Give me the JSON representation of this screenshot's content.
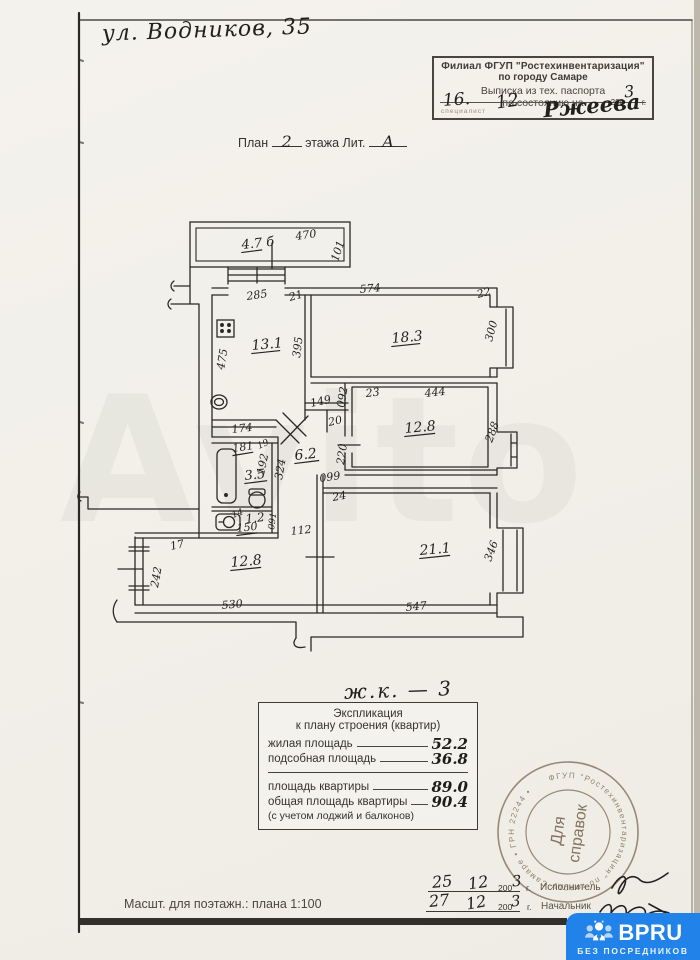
{
  "address": "ул. Водников, 35",
  "stamp_box": {
    "line1": "Филиал ФГУП  \"Ростехинвентаризация\"",
    "line2": "по городу Самаре",
    "line3": "Выписка из тех. паспорта",
    "line4": "по состоянию на",
    "day": "16.",
    "month": "12",
    "year_printed": "200",
    "year_hand": "3",
    "year_unit": "г.",
    "clerk": "специалист",
    "signature": "Ржеева"
  },
  "plan_title": {
    "prefix": "План",
    "floor": "2",
    "middle": "этажа Лит.",
    "letter": "А"
  },
  "apartment_mark": "ж.к. — 3",
  "explication": {
    "title1": "Экспликация",
    "title2": "к плану строения (квартир)",
    "rows": [
      {
        "label": "жилая площадь",
        "value": "52.2"
      },
      {
        "label": "подсобная площадь",
        "value": "36.8"
      },
      {
        "label": "площадь квартиры",
        "value": "89.0"
      },
      {
        "label": "общая площадь квартиры",
        "value": "90.4"
      }
    ],
    "note": "(с учетом лоджий и балконов)"
  },
  "round_stamp": {
    "line1": "Для",
    "line2": "справок",
    "ring_text": "ФГУП \"Ростехинвентаризация\"  по городу Самаре  •  ГРН 22244  •"
  },
  "signoff": [
    {
      "day": "25",
      "month": "12",
      "year_printed": "200",
      "year_hand": "3",
      "year_unit": "г.",
      "role": "Исполнитель"
    },
    {
      "day": "27",
      "month": "12",
      "year_printed": "200",
      "year_hand": "3",
      "year_unit": "г.",
      "role": "Начальник"
    }
  ],
  "scale_note": "Масшт. для поэтажн.: плана 1:100",
  "watermark": {
    "ghost_text": "Avito",
    "badge_title": "BPRU",
    "badge_subtitle": "БЕЗ ПОСРЕДНИКОВ",
    "badge_color": "#2183e9",
    "badge_icon": "people-lock-icon"
  },
  "plan": {
    "labels": [
      {
        "t": "470",
        "x": 296,
        "y": 240,
        "r": -8
      },
      {
        "t": "101",
        "x": 338,
        "y": 262,
        "r": -72
      },
      {
        "t": "4.7 б",
        "x": 242,
        "y": 249,
        "r": -6,
        "fs": 13,
        "u": 20,
        "room": 1
      },
      {
        "t": "285",
        "x": 247,
        "y": 300,
        "r": -8
      },
      {
        "t": "21",
        "x": 290,
        "y": 301,
        "r": -15
      },
      {
        "t": "574",
        "x": 360,
        "y": 293,
        "r": -5
      },
      {
        "t": "22",
        "x": 478,
        "y": 298,
        "r": -15
      },
      {
        "t": "475",
        "x": 224,
        "y": 370,
        "r": -80
      },
      {
        "t": "395",
        "x": 300,
        "y": 358,
        "r": -83
      },
      {
        "t": "13.1",
        "x": 252,
        "y": 350,
        "r": -5,
        "fs": 14,
        "u": 28,
        "room": 1
      },
      {
        "t": "18.3",
        "x": 392,
        "y": 343,
        "r": -5,
        "fs": 14,
        "u": 28,
        "room": 1
      },
      {
        "t": "300",
        "x": 492,
        "y": 342,
        "r": -75
      },
      {
        "t": "23",
        "x": 366,
        "y": 397,
        "r": -6
      },
      {
        "t": "444",
        "x": 425,
        "y": 397,
        "r": -6
      },
      {
        "t": "12.8",
        "x": 405,
        "y": 433,
        "r": -5,
        "fs": 14,
        "u": 30,
        "room": 1
      },
      {
        "t": "288",
        "x": 492,
        "y": 443,
        "r": -70
      },
      {
        "t": "149",
        "x": 311,
        "y": 407,
        "r": -12
      },
      {
        "t": "092",
        "x": 344,
        "y": 408,
        "r": -80
      },
      {
        "t": "20",
        "x": 329,
        "y": 426,
        "r": -12
      },
      {
        "t": "220",
        "x": 344,
        "y": 465,
        "r": -82
      },
      {
        "t": "6.2",
        "x": 295,
        "y": 460,
        "r": -6,
        "fs": 14,
        "u": 24,
        "room": 1
      },
      {
        "t": "174",
        "x": 232,
        "y": 433,
        "r": -6
      },
      {
        "t": "181",
        "x": 233,
        "y": 452,
        "r": -8,
        "u": 20
      },
      {
        "t": "19",
        "x": 259,
        "y": 449,
        "r": -25,
        "fs": 9
      },
      {
        "t": "192",
        "x": 264,
        "y": 475,
        "r": -78
      },
      {
        "t": "324",
        "x": 282,
        "y": 480,
        "r": -80
      },
      {
        "t": "3.5",
        "x": 245,
        "y": 480,
        "r": -6,
        "fs": 13,
        "u": 22,
        "room": 1
      },
      {
        "t": "099",
        "x": 320,
        "y": 482,
        "r": -8
      },
      {
        "t": "24",
        "x": 333,
        "y": 501,
        "r": -10
      },
      {
        "t": "14",
        "x": 233,
        "y": 518,
        "r": -20,
        "fs": 9
      },
      {
        "t": "1.2",
        "x": 246,
        "y": 523,
        "r": -6,
        "fs": 12,
        "room": 1
      },
      {
        "t": "150",
        "x": 237,
        "y": 532,
        "r": -6,
        "u": 20
      },
      {
        "t": "091",
        "x": 274,
        "y": 530,
        "r": -82,
        "fs": 9
      },
      {
        "t": "112",
        "x": 291,
        "y": 535,
        "r": -6
      },
      {
        "t": "17",
        "x": 171,
        "y": 550,
        "r": -12
      },
      {
        "t": "12.8",
        "x": 231,
        "y": 567,
        "r": -5,
        "fs": 14,
        "u": 30,
        "room": 1
      },
      {
        "t": "242",
        "x": 158,
        "y": 588,
        "r": -80
      },
      {
        "t": "530",
        "x": 222,
        "y": 609,
        "r": -5
      },
      {
        "t": "21.1",
        "x": 420,
        "y": 555,
        "r": -5,
        "fs": 14,
        "u": 30,
        "room": 1
      },
      {
        "t": "346",
        "x": 491,
        "y": 562,
        "r": -70
      },
      {
        "t": "547",
        "x": 406,
        "y": 611,
        "r": -5
      }
    ]
  }
}
